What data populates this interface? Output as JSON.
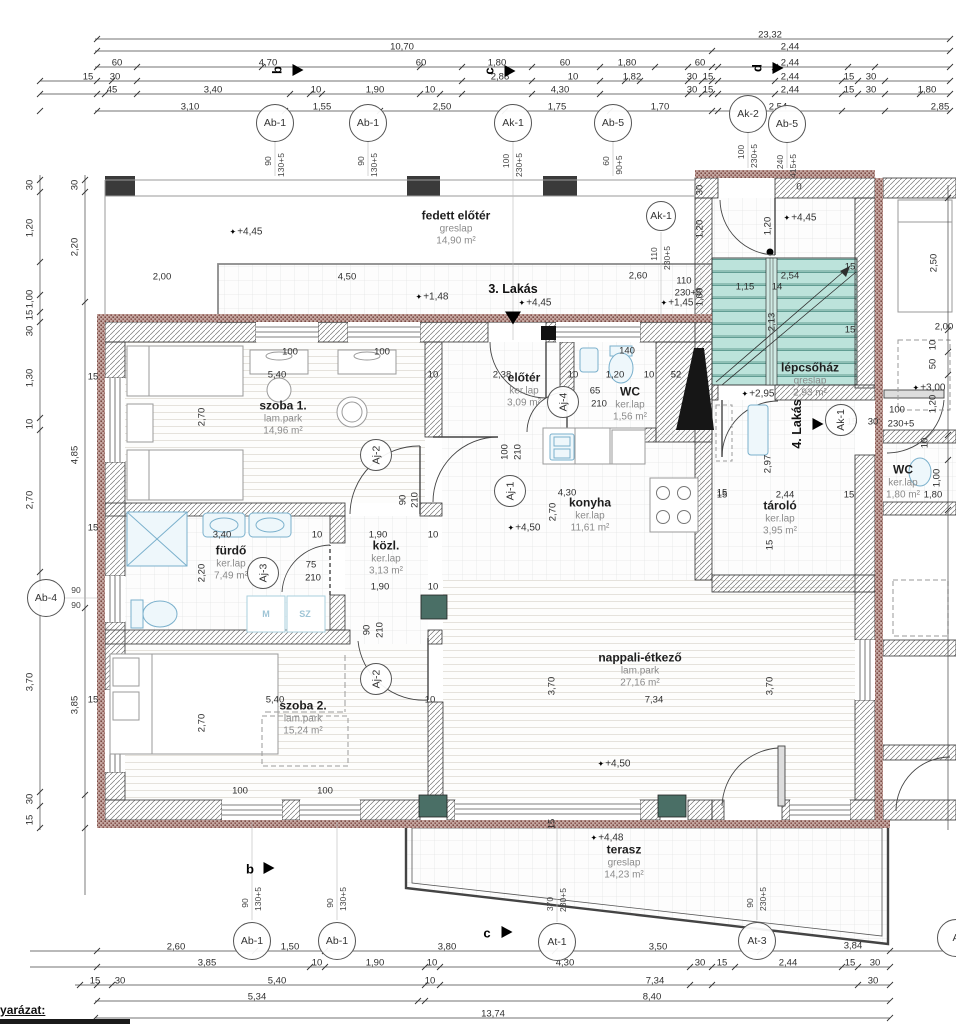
{
  "legend": "jelmagyarázat:",
  "colors": {
    "stair_fill": "#bce3db",
    "brick": "#8a5650",
    "wall_hatch": "#777",
    "shaft_green": "#4a6f66"
  },
  "rooms": [
    {
      "name": "fedett előtér",
      "finish": "greslap",
      "area": "14,90 m²",
      "x": 456,
      "y": 228
    },
    {
      "name": "szoba 1.",
      "finish": "lam.park",
      "area": "14,96 m²",
      "x": 283,
      "y": 418
    },
    {
      "name": "előtér",
      "finish": "ker.lap",
      "area": "3,09 m²",
      "x": 524,
      "y": 390
    },
    {
      "name": "WC",
      "finish": "ker.lap",
      "area": "1,56 m²",
      "x": 630,
      "y": 404
    },
    {
      "name": "konyha",
      "finish": "ker.lap",
      "area": "11,61 m²",
      "x": 590,
      "y": 515
    },
    {
      "name": "fürdő",
      "finish": "ker.lap",
      "area": "7,49 m²",
      "x": 231,
      "y": 563
    },
    {
      "name": "közl.",
      "finish": "ker.lap",
      "area": "3,13 m²",
      "x": 386,
      "y": 558
    },
    {
      "name": "szoba 2.",
      "finish": "lam.park",
      "area": "15,24 m²",
      "x": 303,
      "y": 718
    },
    {
      "name": "nappali-étkező",
      "finish": "lam.park",
      "area": "27,16 m²",
      "x": 640,
      "y": 670
    },
    {
      "name": "lépcsőház",
      "finish": "greslap",
      "area": "2,93 m²",
      "x": 810,
      "y": 380
    },
    {
      "name": "tároló",
      "finish": "ker.lap",
      "area": "3,95 m²",
      "x": 780,
      "y": 518
    },
    {
      "name": "WC",
      "finish": "ker.lap",
      "area": "1,80 m²",
      "x": 903,
      "y": 482
    },
    {
      "name": "terasz",
      "finish": "greslap",
      "area": "14,23 m²",
      "x": 624,
      "y": 862
    }
  ],
  "apartments": [
    {
      "t": "3. Lakás",
      "x": 513,
      "y": 289,
      "tri": "down",
      "tx": 513,
      "ty": 318
    },
    {
      "t": "4. Lakás",
      "x": 797,
      "y": 424,
      "r": 1,
      "tri": "right",
      "tx": 818,
      "ty": 424
    }
  ],
  "sections": [
    {
      "t": "b",
      "x": 277,
      "y": 70,
      "r": 1,
      "tx": 298,
      "ty": 70
    },
    {
      "t": "c",
      "x": 489,
      "y": 71,
      "r": 1,
      "tx": 510,
      "ty": 71
    },
    {
      "t": "d",
      "x": 757,
      "y": 68,
      "r": 1,
      "tx": 778,
      "ty": 68
    },
    {
      "t": "b",
      "x": 250,
      "y": 869,
      "tx": 269,
      "ty": 868
    },
    {
      "t": "c",
      "x": 487,
      "y": 933,
      "tx": 507,
      "ty": 932
    }
  ],
  "elevations": [
    {
      "t": "+4,45",
      "x": 246,
      "y": 232
    },
    {
      "t": "+4,45",
      "x": 800,
      "y": 218
    },
    {
      "t": "+4,45",
      "x": 535,
      "y": 303
    },
    {
      "t": "+1,48",
      "x": 432,
      "y": 297
    },
    {
      "t": "+1,45",
      "x": 677,
      "y": 303
    },
    {
      "t": "+4,50",
      "x": 524,
      "y": 528
    },
    {
      "t": "+4,50",
      "x": 614,
      "y": 764
    },
    {
      "t": "+2,95",
      "x": 758,
      "y": 394
    },
    {
      "t": "+3,00",
      "x": 929,
      "y": 388
    },
    {
      "t": "+4,48",
      "x": 607,
      "y": 838
    }
  ],
  "markers": [
    {
      "l": "Ab-1",
      "x": 275,
      "y": 123,
      "s1": "90",
      "s2": "130+5",
      "sp": "t"
    },
    {
      "l": "Ab-1",
      "x": 368,
      "y": 123,
      "s1": "90",
      "s2": "130+5",
      "sp": "t"
    },
    {
      "l": "Ak-1",
      "x": 513,
      "y": 123,
      "s1": "100",
      "s2": "230+5",
      "sp": "t"
    },
    {
      "l": "Ab-5",
      "x": 613,
      "y": 123,
      "s1": "60",
      "s2": "90+5",
      "sp": "t"
    },
    {
      "l": "Ak-2",
      "x": 748,
      "y": 114,
      "s1": "100",
      "s2": "230+5",
      "sp": "t"
    },
    {
      "l": "Ab-5",
      "x": 787,
      "y": 124,
      "s1": "240",
      "s2": "415+5",
      "sp": "t"
    },
    {
      "l": "Ak-1",
      "x": 661,
      "y": 216,
      "d": 28,
      "s1": "110",
      "s2": "230+5",
      "sp": "t"
    },
    {
      "l": "Ab-4",
      "x": 46,
      "y": 598,
      "s1": "90",
      "s2": "90",
      "sp": "r"
    },
    {
      "l": "Aj-2",
      "x": 376,
      "y": 455,
      "rot": 1,
      "d": 30
    },
    {
      "l": "Aj-1",
      "x": 510,
      "y": 491,
      "rot": 1,
      "d": 30
    },
    {
      "l": "Aj-3",
      "x": 263,
      "y": 573,
      "rot": 1,
      "d": 30
    },
    {
      "l": "Aj-4",
      "x": 563,
      "y": 402,
      "rot": 1,
      "d": 30
    },
    {
      "l": "Aj-2",
      "x": 376,
      "y": 679,
      "rot": 1,
      "d": 30
    },
    {
      "l": "Ak-1",
      "x": 841,
      "y": 420,
      "rot": 1,
      "d": 30
    },
    {
      "l": "Ab-1",
      "x": 252,
      "y": 941,
      "s1": "90",
      "s2": "130+5",
      "sp": "b"
    },
    {
      "l": "Ab-1",
      "x": 337,
      "y": 941,
      "s1": "90",
      "s2": "130+5",
      "sp": "b"
    },
    {
      "l": "At-1",
      "x": 557,
      "y": 942,
      "s1": "370",
      "s2": "230+5",
      "sp": "b"
    },
    {
      "l": "At-3",
      "x": 757,
      "y": 941,
      "s1": "90",
      "s2": "230+5",
      "sp": "b"
    },
    {
      "l": "A",
      "x": 956,
      "y": 938
    }
  ],
  "fixtures": [
    {
      "t": "M",
      "x": 266,
      "y": 614
    },
    {
      "t": "SZ",
      "x": 305,
      "y": 614
    }
  ],
  "dims": [
    {
      "t": "23,32",
      "x": 770,
      "y": 35
    },
    {
      "t": "10,70",
      "x": 402,
      "y": 47
    },
    {
      "t": "2,44",
      "x": 790,
      "y": 47
    },
    {
      "t": "60",
      "x": 117,
      "y": 63
    },
    {
      "t": "4,70",
      "x": 268,
      "y": 63
    },
    {
      "t": "60",
      "x": 421,
      "y": 63
    },
    {
      "t": "1,80",
      "x": 497,
      "y": 63
    },
    {
      "t": "60",
      "x": 565,
      "y": 63
    },
    {
      "t": "1,80",
      "x": 627,
      "y": 63
    },
    {
      "t": "60",
      "x": 700,
      "y": 63
    },
    {
      "t": "2,44",
      "x": 790,
      "y": 63
    },
    {
      "t": "15",
      "x": 88,
      "y": 77
    },
    {
      "t": "30",
      "x": 115,
      "y": 77
    },
    {
      "t": "2,88",
      "x": 500,
      "y": 77
    },
    {
      "t": "10",
      "x": 573,
      "y": 77
    },
    {
      "t": "1,82",
      "x": 632,
      "y": 77
    },
    {
      "t": "30",
      "x": 692,
      "y": 77
    },
    {
      "t": "15",
      "x": 708,
      "y": 77
    },
    {
      "t": "2,44",
      "x": 790,
      "y": 77
    },
    {
      "t": "15",
      "x": 849,
      "y": 77
    },
    {
      "t": "30",
      "x": 871,
      "y": 77
    },
    {
      "t": "45",
      "x": 112,
      "y": 90
    },
    {
      "t": "3,40",
      "x": 213,
      "y": 90
    },
    {
      "t": "10",
      "x": 316,
      "y": 90
    },
    {
      "t": "1,90",
      "x": 375,
      "y": 90
    },
    {
      "t": "10",
      "x": 430,
      "y": 90
    },
    {
      "t": "4,30",
      "x": 560,
      "y": 90
    },
    {
      "t": "30",
      "x": 692,
      "y": 90
    },
    {
      "t": "15",
      "x": 708,
      "y": 90
    },
    {
      "t": "2,44",
      "x": 790,
      "y": 90
    },
    {
      "t": "15",
      "x": 849,
      "y": 90
    },
    {
      "t": "30",
      "x": 871,
      "y": 90
    },
    {
      "t": "1,80",
      "x": 927,
      "y": 90
    },
    {
      "t": "3,10",
      "x": 190,
      "y": 107
    },
    {
      "t": "1,55",
      "x": 322,
      "y": 107
    },
    {
      "t": "2,50",
      "x": 442,
      "y": 107
    },
    {
      "t": "1,75",
      "x": 557,
      "y": 107
    },
    {
      "t": "1,70",
      "x": 660,
      "y": 107
    },
    {
      "t": "2,54",
      "x": 778,
      "y": 107
    },
    {
      "t": "2,85",
      "x": 940,
      "y": 107
    },
    {
      "t": "30",
      "x": 30,
      "y": 185,
      "r": 1
    },
    {
      "t": "30",
      "x": 75,
      "y": 185,
      "r": 1
    },
    {
      "t": "1,20",
      "x": 30,
      "y": 228,
      "r": 1
    },
    {
      "t": "2,20",
      "x": 75,
      "y": 247,
      "r": 1
    },
    {
      "t": "1,00",
      "x": 30,
      "y": 299,
      "r": 1
    },
    {
      "t": "15",
      "x": 30,
      "y": 315,
      "r": 1
    },
    {
      "t": "30",
      "x": 30,
      "y": 331,
      "r": 1
    },
    {
      "t": "1,30",
      "x": 30,
      "y": 378,
      "r": 1
    },
    {
      "t": "10",
      "x": 30,
      "y": 424,
      "r": 1
    },
    {
      "t": "4,85",
      "x": 75,
      "y": 455,
      "r": 1
    },
    {
      "t": "2,70",
      "x": 30,
      "y": 500,
      "r": 1
    },
    {
      "t": "3,70",
      "x": 30,
      "y": 682,
      "r": 1
    },
    {
      "t": "3,85",
      "x": 75,
      "y": 705,
      "r": 1
    },
    {
      "t": "30",
      "x": 30,
      "y": 799,
      "r": 1
    },
    {
      "t": "15",
      "x": 30,
      "y": 820,
      "r": 1
    },
    {
      "t": "15",
      "x": 93,
      "y": 377
    },
    {
      "t": "15",
      "x": 93,
      "y": 528
    },
    {
      "t": "15",
      "x": 93,
      "y": 700
    },
    {
      "t": "30",
      "x": 700,
      "y": 190,
      "r": 1
    },
    {
      "t": "1,20",
      "x": 700,
      "y": 229,
      "r": 1
    },
    {
      "t": "1,00",
      "x": 700,
      "y": 297,
      "r": 1
    },
    {
      "t": "2,00",
      "x": 162,
      "y": 277
    },
    {
      "t": "4,50",
      "x": 347,
      "y": 277
    },
    {
      "t": "2,60",
      "x": 638,
      "y": 276
    },
    {
      "t": "110",
      "x": 684,
      "y": 281
    },
    {
      "t": "230+5",
      "x": 688,
      "y": 293
    },
    {
      "t": "0",
      "x": 799,
      "y": 187
    },
    {
      "t": "1,20",
      "x": 768,
      "y": 226,
      "r": 1
    },
    {
      "t": "100",
      "x": 290,
      "y": 352
    },
    {
      "t": "100",
      "x": 382,
      "y": 352
    },
    {
      "t": "5,40",
      "x": 277,
      "y": 375
    },
    {
      "t": "10",
      "x": 433,
      "y": 375
    },
    {
      "t": "2,70",
      "x": 202,
      "y": 417,
      "r": 1
    },
    {
      "t": "2,38",
      "x": 502,
      "y": 375
    },
    {
      "t": "10",
      "x": 573,
      "y": 375
    },
    {
      "t": "1,20",
      "x": 615,
      "y": 375
    },
    {
      "t": "10",
      "x": 649,
      "y": 375
    },
    {
      "t": "52",
      "x": 676,
      "y": 375
    },
    {
      "t": "140",
      "x": 627,
      "y": 351
    },
    {
      "t": "65",
      "x": 595,
      "y": 391
    },
    {
      "t": "210",
      "x": 599,
      "y": 404
    },
    {
      "t": "90",
      "x": 403,
      "y": 500,
      "r": 1
    },
    {
      "t": "210",
      "x": 415,
      "y": 500,
      "r": 1
    },
    {
      "t": "100",
      "x": 505,
      "y": 452,
      "r": 1
    },
    {
      "t": "210",
      "x": 518,
      "y": 452,
      "r": 1
    },
    {
      "t": "3,40",
      "x": 222,
      "y": 535
    },
    {
      "t": "10",
      "x": 317,
      "y": 535
    },
    {
      "t": "2,20",
      "x": 202,
      "y": 573,
      "r": 1
    },
    {
      "t": "1,90",
      "x": 378,
      "y": 535
    },
    {
      "t": "10",
      "x": 433,
      "y": 535
    },
    {
      "t": "1,90",
      "x": 380,
      "y": 587
    },
    {
      "t": "10",
      "x": 433,
      "y": 587
    },
    {
      "t": "75",
      "x": 311,
      "y": 565
    },
    {
      "t": "210",
      "x": 313,
      "y": 578
    },
    {
      "t": "90",
      "x": 367,
      "y": 630,
      "r": 1
    },
    {
      "t": "210",
      "x": 380,
      "y": 630,
      "r": 1
    },
    {
      "t": "4,30",
      "x": 567,
      "y": 493
    },
    {
      "t": "2,70",
      "x": 553,
      "y": 512,
      "r": 1
    },
    {
      "t": "15",
      "x": 722,
      "y": 493
    },
    {
      "t": "5,40",
      "x": 275,
      "y": 700
    },
    {
      "t": "10",
      "x": 430,
      "y": 700
    },
    {
      "t": "2,70",
      "x": 202,
      "y": 723,
      "r": 1
    },
    {
      "t": "100",
      "x": 240,
      "y": 791
    },
    {
      "t": "100",
      "x": 325,
      "y": 791
    },
    {
      "t": "7,34",
      "x": 654,
      "y": 700
    },
    {
      "t": "3,70",
      "x": 552,
      "y": 686,
      "r": 1
    },
    {
      "t": "3,70",
      "x": 770,
      "y": 686,
      "r": 1
    },
    {
      "t": "1,15",
      "x": 745,
      "y": 287
    },
    {
      "t": "14",
      "x": 777,
      "y": 287
    },
    {
      "t": "2,13",
      "x": 772,
      "y": 322,
      "r": 1
    },
    {
      "t": "2,54",
      "x": 790,
      "y": 276
    },
    {
      "t": "15",
      "x": 850,
      "y": 267
    },
    {
      "t": "15",
      "x": 850,
      "y": 330
    },
    {
      "t": "15",
      "x": 722,
      "y": 495
    },
    {
      "t": "2,44",
      "x": 785,
      "y": 495
    },
    {
      "t": "15",
      "x": 849,
      "y": 495
    },
    {
      "t": "2,97",
      "x": 768,
      "y": 464,
      "r": 1
    },
    {
      "t": "15",
      "x": 770,
      "y": 545,
      "r": 1
    },
    {
      "t": "100",
      "x": 897,
      "y": 410
    },
    {
      "t": "230+5",
      "x": 901,
      "y": 424
    },
    {
      "t": "15",
      "x": 852,
      "y": 422
    },
    {
      "t": "30",
      "x": 873,
      "y": 422
    },
    {
      "t": "1,80",
      "x": 933,
      "y": 495
    },
    {
      "t": "1,00",
      "x": 937,
      "y": 478,
      "r": 1
    },
    {
      "t": "2,50",
      "x": 934,
      "y": 263,
      "r": 1
    },
    {
      "t": "2,00",
      "x": 944,
      "y": 327
    },
    {
      "t": "10",
      "x": 933,
      "y": 345,
      "r": 1
    },
    {
      "t": "50",
      "x": 933,
      "y": 364,
      "r": 1
    },
    {
      "t": "1,20",
      "x": 933,
      "y": 404,
      "r": 1
    },
    {
      "t": "10",
      "x": 925,
      "y": 443,
      "r": 1
    },
    {
      "t": "15",
      "x": 552,
      "y": 824,
      "r": 1
    },
    {
      "t": "2,60",
      "x": 176,
      "y": 947
    },
    {
      "t": "1,50",
      "x": 290,
      "y": 947
    },
    {
      "t": "3,80",
      "x": 447,
      "y": 947
    },
    {
      "t": "3,50",
      "x": 658,
      "y": 947
    },
    {
      "t": "3,84",
      "x": 853,
      "y": 946
    },
    {
      "t": "3,85",
      "x": 207,
      "y": 963
    },
    {
      "t": "10",
      "x": 317,
      "y": 963
    },
    {
      "t": "1,90",
      "x": 375,
      "y": 963
    },
    {
      "t": "10",
      "x": 432,
      "y": 963
    },
    {
      "t": "4,30",
      "x": 565,
      "y": 963
    },
    {
      "t": "30",
      "x": 700,
      "y": 963
    },
    {
      "t": "15",
      "x": 722,
      "y": 963
    },
    {
      "t": "2,44",
      "x": 788,
      "y": 963
    },
    {
      "t": "15",
      "x": 850,
      "y": 963
    },
    {
      "t": "30",
      "x": 875,
      "y": 963
    },
    {
      "t": "15",
      "x": 95,
      "y": 981
    },
    {
      "t": "30",
      "x": 120,
      "y": 981
    },
    {
      "t": "5,40",
      "x": 277,
      "y": 981
    },
    {
      "t": "10",
      "x": 430,
      "y": 981
    },
    {
      "t": "7,34",
      "x": 655,
      "y": 981
    },
    {
      "t": "30",
      "x": 873,
      "y": 981
    },
    {
      "t": "5,34",
      "x": 257,
      "y": 997
    },
    {
      "t": "8,40",
      "x": 652,
      "y": 997
    },
    {
      "t": "13,74",
      "x": 493,
      "y": 1014
    }
  ]
}
